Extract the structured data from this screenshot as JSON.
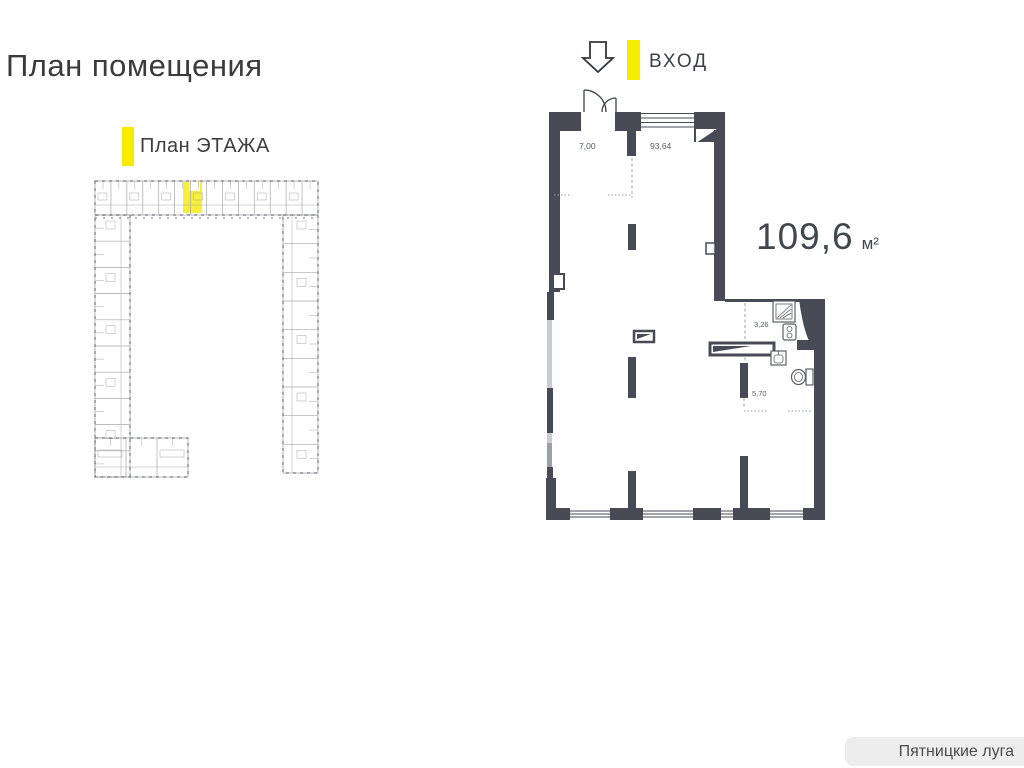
{
  "page": {
    "title": "План помещения"
  },
  "legend": {
    "floor_plan_label": "План ЭТАЖА"
  },
  "entrance": {
    "label": "ВХОД"
  },
  "area": {
    "value": "109,6",
    "unit": "м²"
  },
  "room_labels": {
    "hall": "7,00",
    "main": "93,64",
    "bath_small": "3,26",
    "bath_large": "5,70"
  },
  "footer": {
    "brand": "Пятницкие луга"
  },
  "colors": {
    "wall": "#484b55",
    "accent_yellow": "#f6ec00",
    "highlight_yellow": "#f7ee3a",
    "window_light": "#c9cdd3",
    "window_mid": "#9aa0a8",
    "miniplan_line": "#a7a7a7",
    "miniplan_dash": "#6f747c",
    "text_dark": "#3f434c",
    "footer_bg": "#ededee",
    "footer_text": "#4c4c4c"
  }
}
